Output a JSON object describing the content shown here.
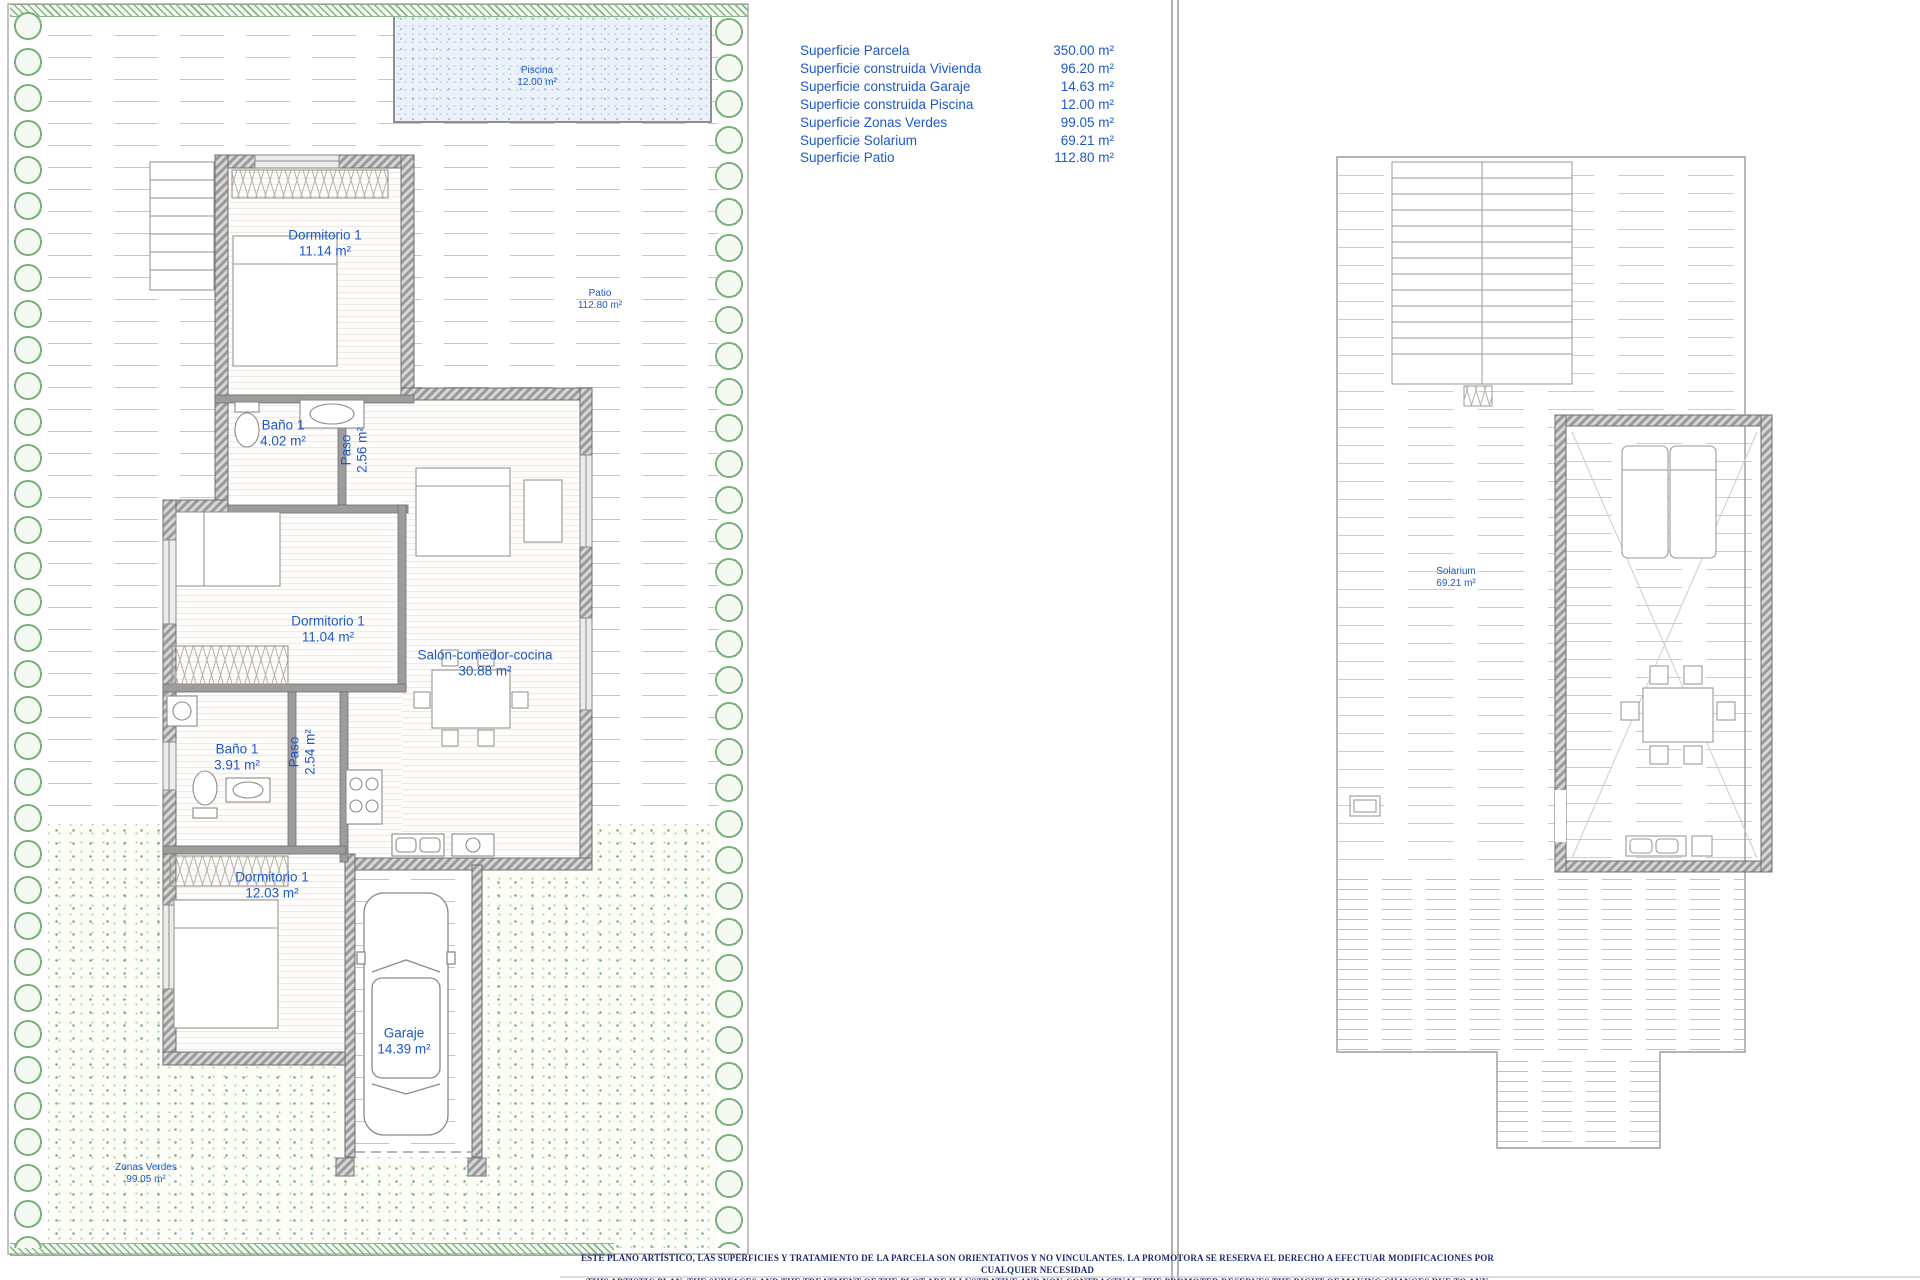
{
  "colors": {
    "label_blue": "#1e58c8",
    "disclaimer_navy": "#1d2b6e",
    "wall_gray": "#9c9c9c",
    "pool_fill": "#eaf1f9",
    "garden_green": "#7cb07c"
  },
  "surface_table": {
    "rows": [
      {
        "label": "Superficie Parcela",
        "value": "350.00 m²"
      },
      {
        "label": "Superficie construida Vivienda",
        "value": "96.20 m²"
      },
      {
        "label": "Superficie construida Garaje",
        "value": "14.63 m²"
      },
      {
        "label": "Superficie construida Piscina",
        "value": "12.00 m²"
      },
      {
        "label": "Superficie Zonas Verdes",
        "value": "99.05 m²"
      },
      {
        "label": "Superficie Solarium",
        "value": "69.21 m²"
      },
      {
        "label": "Superficie Patio",
        "value": "112.80 m²"
      }
    ]
  },
  "ground_floor": {
    "piscina": {
      "name": "Piscina",
      "area": "12.00 m²"
    },
    "patio": {
      "name": "Patio",
      "area": "112.80 m²"
    },
    "dormitorio_top": {
      "name": "Dormitorio 1",
      "area": "11.14 m²"
    },
    "bano_top": {
      "name": "Baño 1",
      "area": "4.02 m²"
    },
    "paso_top": {
      "name": "Paso",
      "area": "2.56 m²"
    },
    "dormitorio_mid": {
      "name": "Dormitorio 1",
      "area": "11.04 m²"
    },
    "salon": {
      "name": "Salón-comedor-cocina",
      "area": "30.88 m²"
    },
    "bano_low": {
      "name": "Baño 1",
      "area": "3.91 m²"
    },
    "paso_low": {
      "name": "Paso",
      "area": "2.54 m²"
    },
    "dormitorio_low": {
      "name": "Dormitorio 1",
      "area": "12.03 m²"
    },
    "garaje": {
      "name": "Garaje",
      "area": "14.39 m²"
    },
    "zonas_verdes": {
      "name": "Zonas Verdes",
      "area": "99.05 m²"
    }
  },
  "roof": {
    "solarium": {
      "name": "Solarium",
      "area": "69.21 m²"
    }
  },
  "disclaimer": {
    "line1": "ESTE PLANO ARTÍSTICO, LAS SUPERFICIES Y TRATAMIENTO DE LA PARCELA SON ORIENTATIVOS Y NO VINCULANTES. LA PROMOTORA SE RESERVA EL DERECHO A EFECTUAR MODIFICACIONES POR CUALQUIER NECESIDAD",
    "line2": "THIS ARTISTIC PLAN, THE SURFACES AND THE TREATMENT OF THE PLOT ARE ILLUSTRATIVE AND NON-CONTRACTUAL. THE PROMOTER RESERVES THE RIGHT OF MAKING CHANGES DUE TO ANY NECESSITY"
  }
}
